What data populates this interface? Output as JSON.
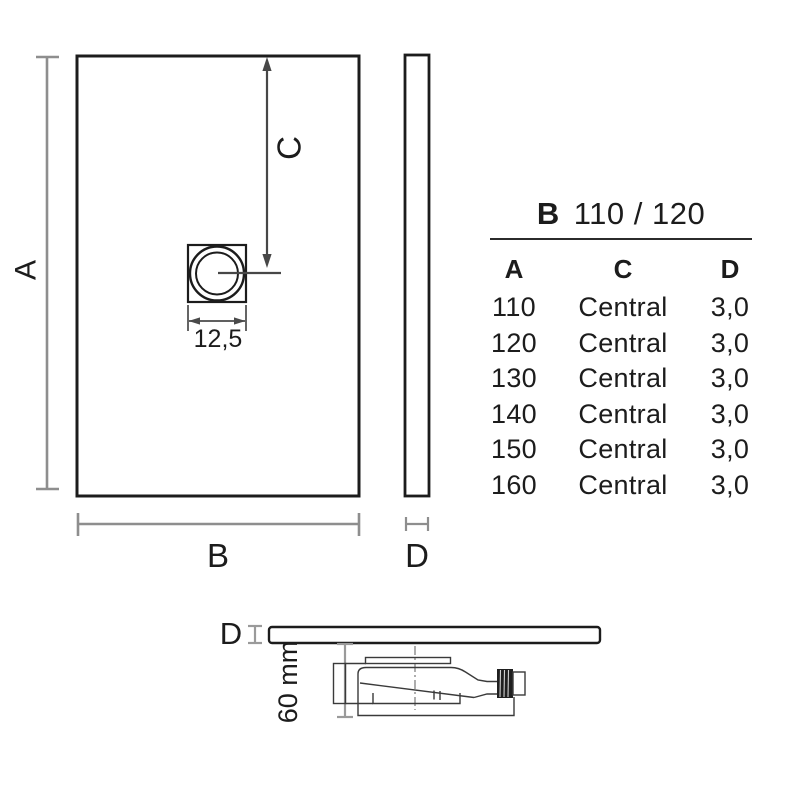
{
  "colors": {
    "outline": "#1c1c1c",
    "dim_gray": "#8e8e8e",
    "dim_dark": "#474747",
    "section_gray": "#9a9a9a",
    "background": "#ffffff"
  },
  "plan_view": {
    "label_a": "A",
    "label_b": "B",
    "label_c": "C",
    "drain_width": "12,5"
  },
  "side_view": {
    "label_d": "D"
  },
  "section_view": {
    "label_d": "D",
    "depth": "60 mm"
  },
  "spec_table": {
    "title_model": "B",
    "title_sizes": "110 / 120",
    "headers": [
      "A",
      "C",
      "D"
    ],
    "rows": [
      [
        "110",
        "Central",
        "3,0"
      ],
      [
        "120",
        "Central",
        "3,0"
      ],
      [
        "130",
        "Central",
        "3,0"
      ],
      [
        "140",
        "Central",
        "3,0"
      ],
      [
        "150",
        "Central",
        "3,0"
      ],
      [
        "160",
        "Central",
        "3,0"
      ]
    ]
  }
}
